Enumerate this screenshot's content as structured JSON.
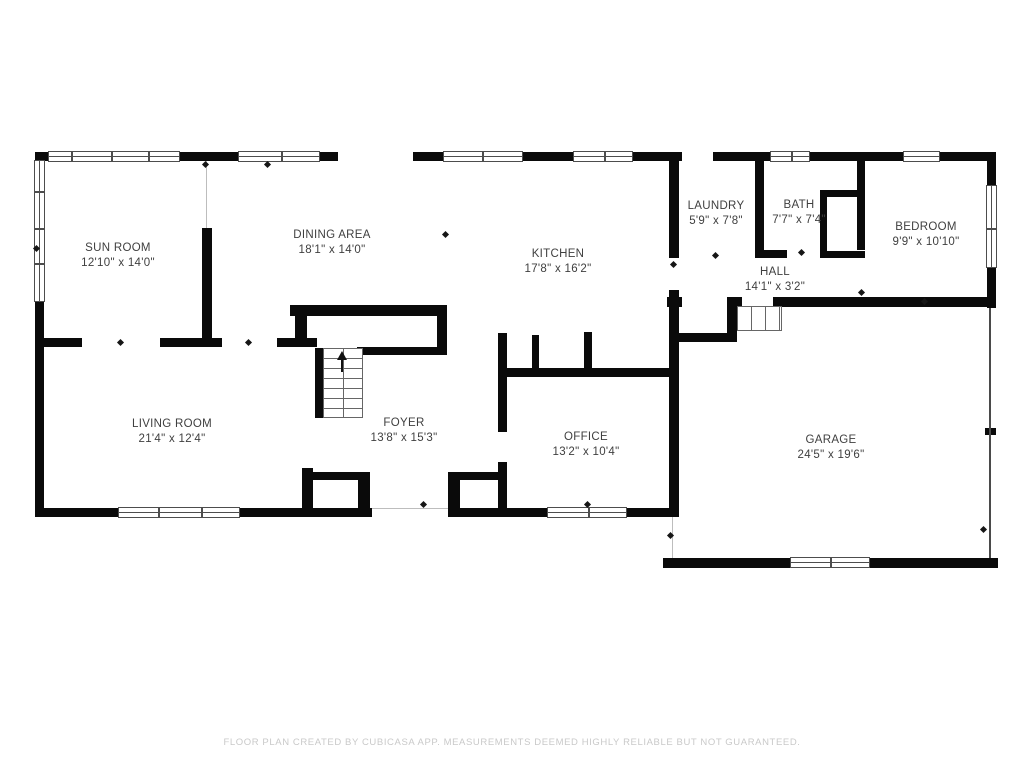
{
  "colors": {
    "wall": "#0a0a0a",
    "room_text": "#3f3f3f",
    "footer_text": "#c9c9c9",
    "window_line": "#4d4d4d",
    "background": "#ffffff"
  },
  "rooms": {
    "sun_room": {
      "name": "SUN ROOM",
      "dims": "12'10\" x 14'0\""
    },
    "dining_area": {
      "name": "DINING AREA",
      "dims": "18'1\" x 14'0\""
    },
    "kitchen": {
      "name": "KITCHEN",
      "dims": "17'8\" x 16'2\""
    },
    "laundry": {
      "name": "LAUNDRY",
      "dims": "5'9\" x 7'8\""
    },
    "bath": {
      "name": "BATH",
      "dims": "7'7\" x 7'4\""
    },
    "bedroom": {
      "name": "BEDROOM",
      "dims": "9'9\" x 10'10\""
    },
    "hall": {
      "name": "HALL",
      "dims": "14'1\" x 3'2\""
    },
    "living_room": {
      "name": "LIVING ROOM",
      "dims": "21'4\" x 12'4\""
    },
    "foyer": {
      "name": "FOYER",
      "dims": "13'8\" x 15'3\""
    },
    "office": {
      "name": "OFFICE",
      "dims": "13'2\" x 10'4\""
    },
    "garage": {
      "name": "GARAGE",
      "dims": "24'5\" x 19'6\""
    }
  },
  "footer": {
    "text": "FLOOR PLAN CREATED BY CUBICASA APP. MEASUREMENTS DEEMED HIGHLY RELIABLE BUT NOT GUARANTEED."
  }
}
